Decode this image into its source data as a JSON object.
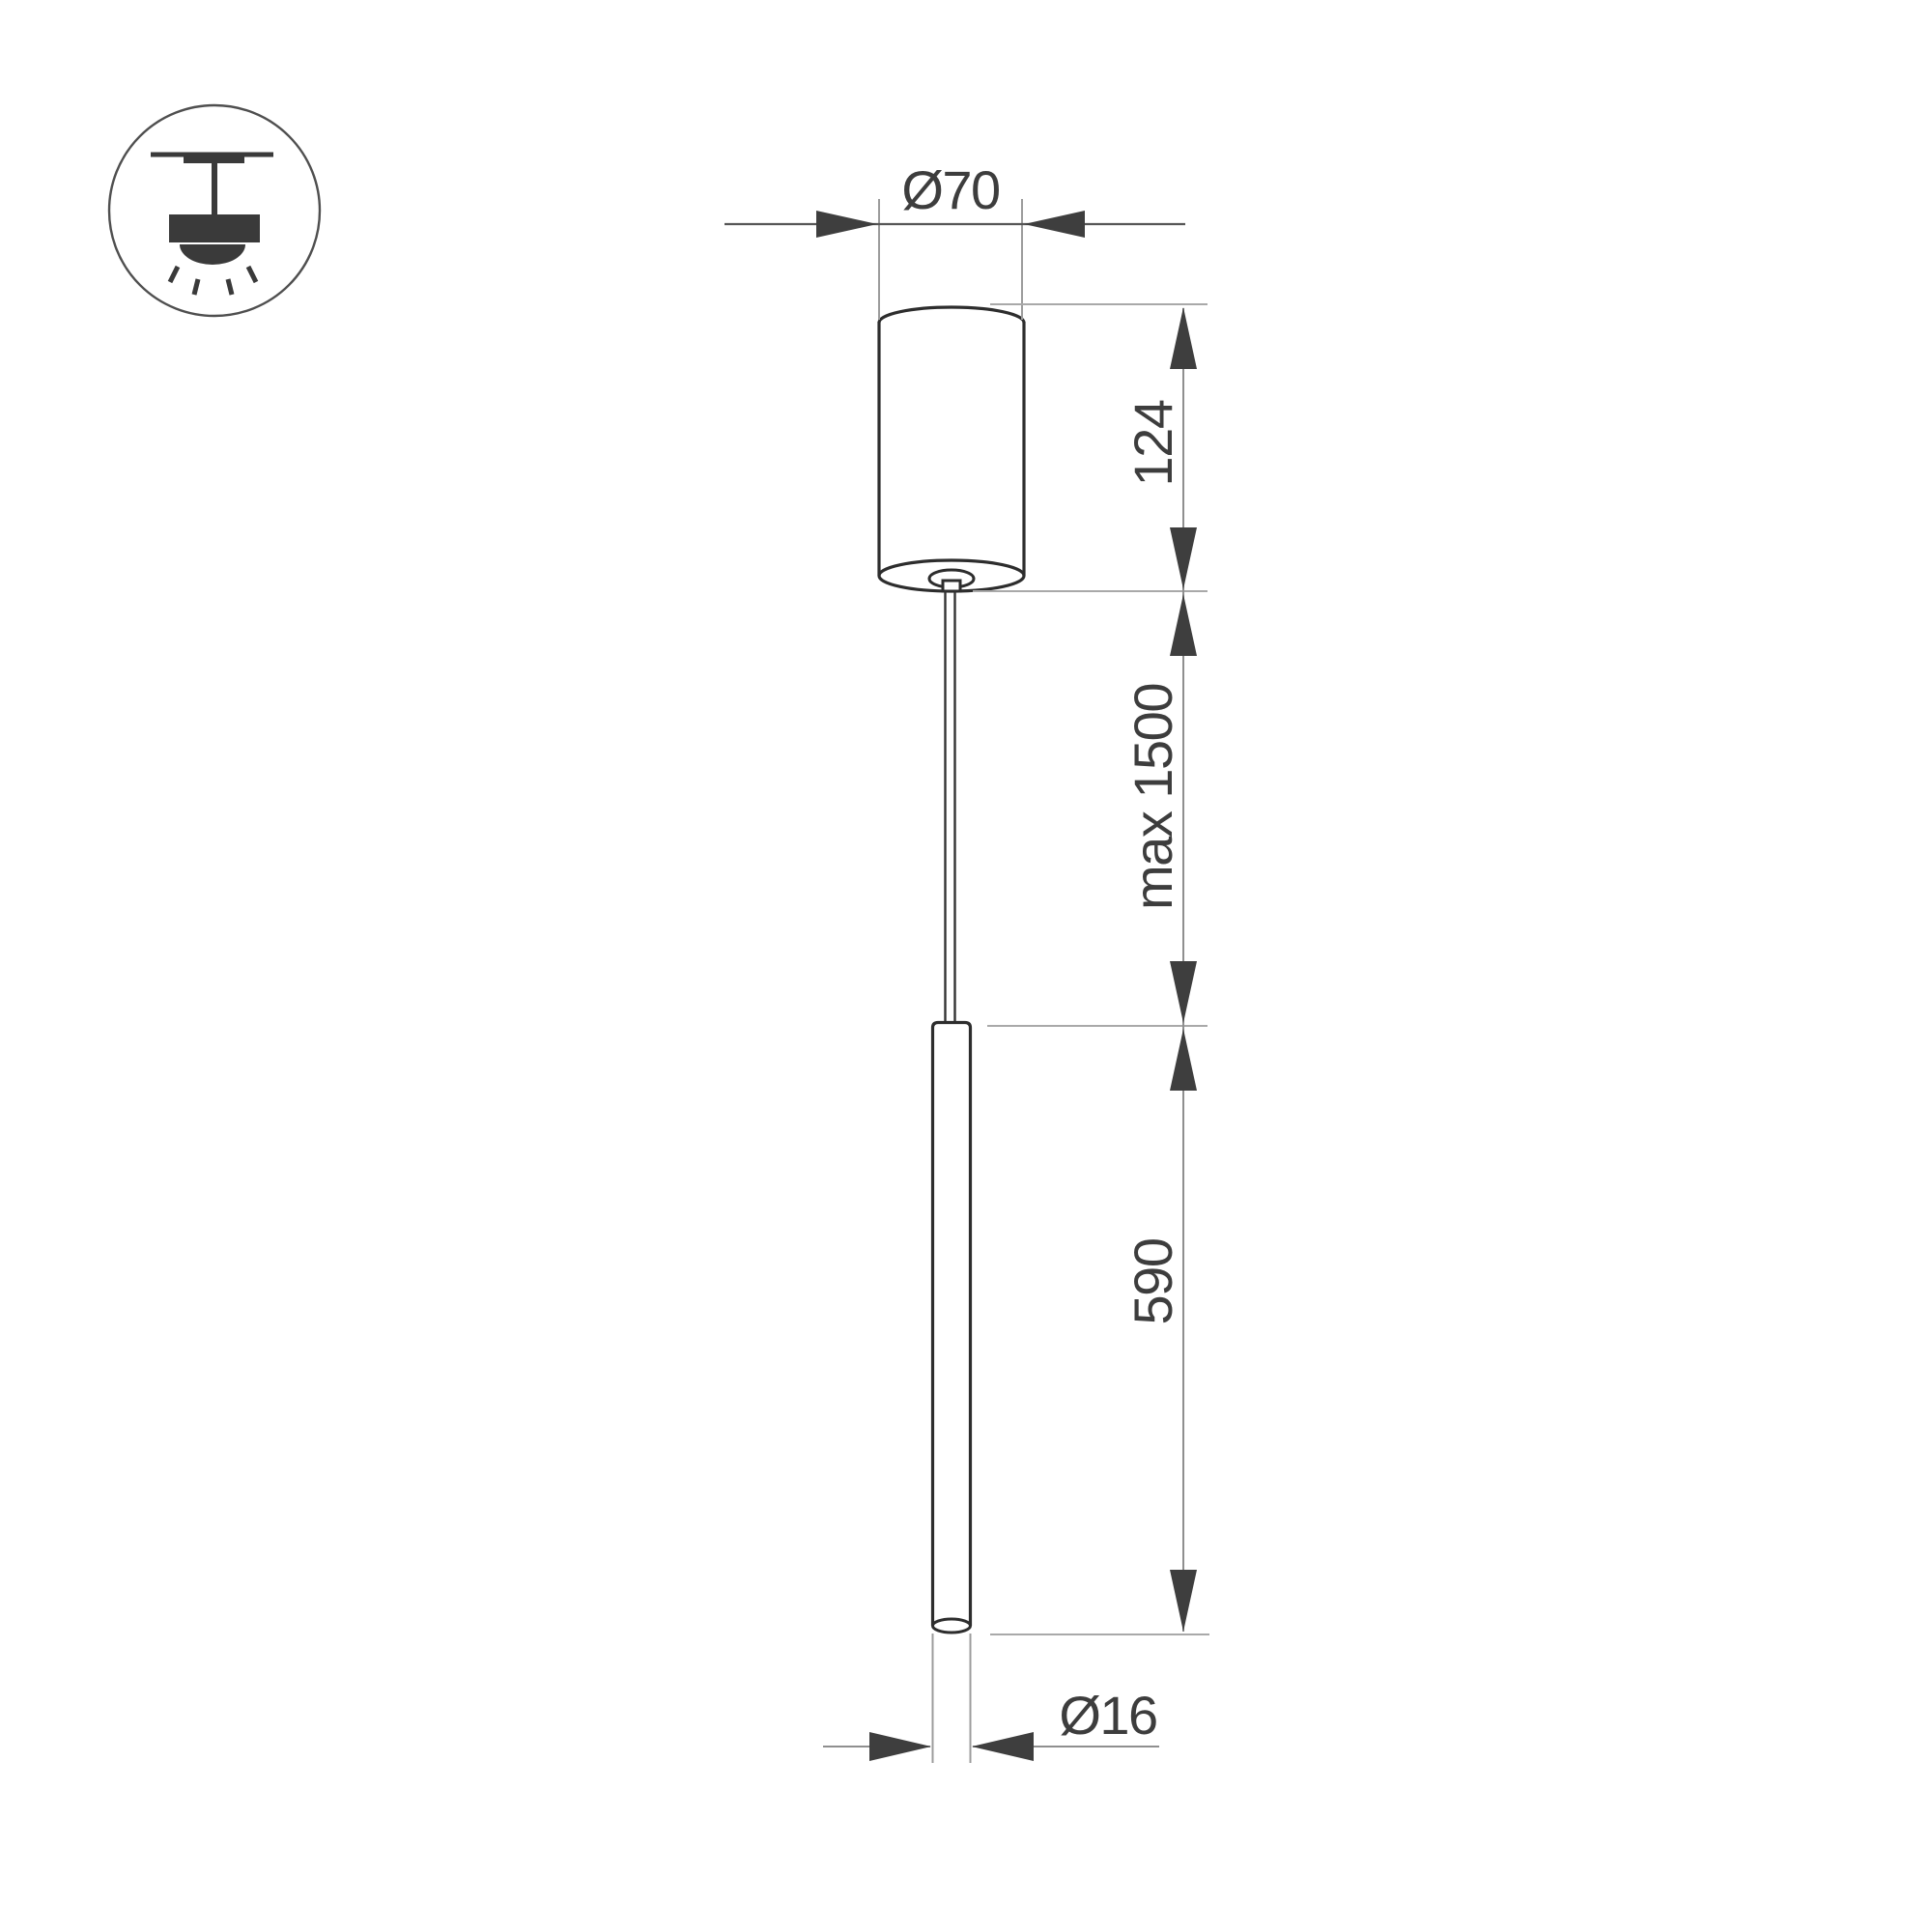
{
  "page": {
    "type": "technical-dimension-drawing",
    "background": "#ffffff",
    "subject": "pendant LED luminaire side view"
  },
  "icon": {
    "name": "pendant-ceiling-light-icon",
    "description": "ceiling-mounted pendant light with downward light rays"
  },
  "dimensions": {
    "canopy_diameter_label": "Ø70",
    "canopy_height_label": "124",
    "suspension_length_label": "max 1500",
    "tube_length_label": "590",
    "tube_diameter_label": "Ø16"
  },
  "colors": {
    "outline": "#2d2d2d",
    "wire": "#333333",
    "arrow": "#3e3e3e",
    "dimension_text": "#3d3d3d",
    "dimension_line": "#8f8f8f",
    "dim_line_dark": "#565656",
    "extension_line": "#a9a9a9",
    "ext_line_light": "#9c9c9c",
    "icon_ink": "#3a3a3a",
    "icon_circle": "#4f4f4f"
  }
}
